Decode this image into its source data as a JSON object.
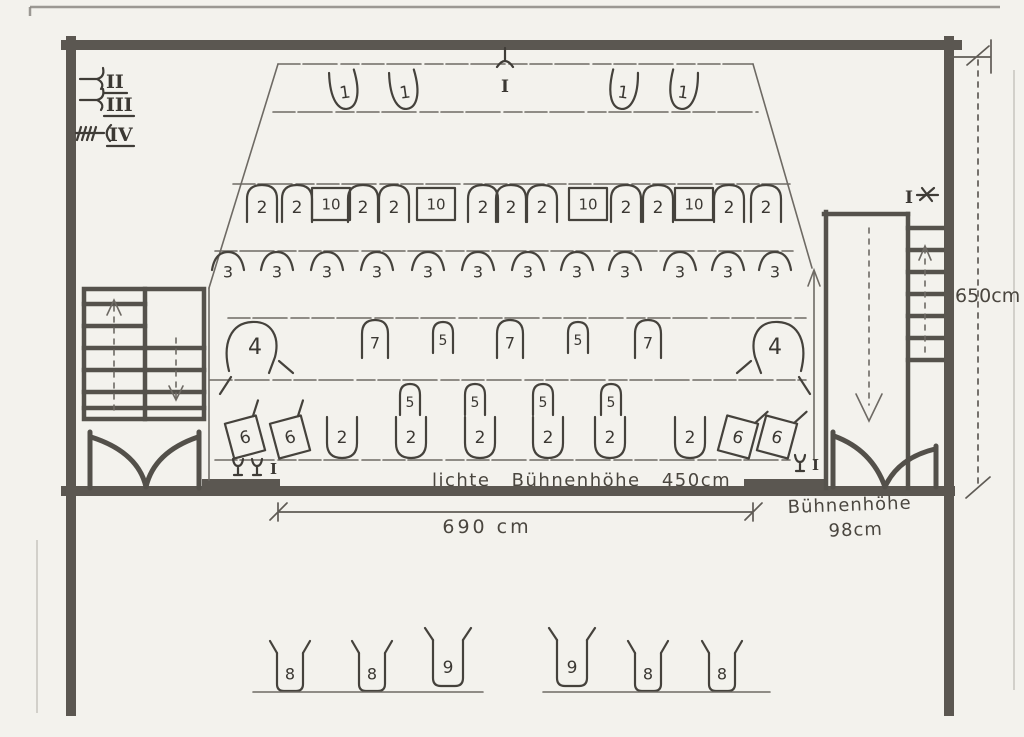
{
  "paper": {
    "bg": "#f3f2ed",
    "wall_color": "#5b5751",
    "pencil_color": "#6e6a64",
    "ink_color": "#45423c"
  },
  "legend": {
    "items": [
      {
        "numeral": "II"
      },
      {
        "numeral": "III"
      },
      {
        "numeral": "IV"
      }
    ]
  },
  "markers": {
    "top_center": "I",
    "right_wall": "I",
    "stage_left": "I",
    "stage_right": "I"
  },
  "dimensions": {
    "stage_width": "690 cm",
    "clear_stage_height": "lichte Bühnenhöhe 450cm",
    "stage_height_label": "Bühnenhöhe",
    "stage_height_value": "98cm",
    "room_height": "650cm"
  },
  "fixture_rows": [
    {
      "name": "row-1-top-lights",
      "items": [
        {
          "type": "open-u",
          "x": 345,
          "y": 93,
          "rot": -8,
          "label": "1"
        },
        {
          "type": "open-u",
          "x": 405,
          "y": 93,
          "rot": -8,
          "label": "1"
        },
        {
          "type": "open-u",
          "x": 623,
          "y": 93,
          "rot": 8,
          "label": "1"
        },
        {
          "type": "open-u",
          "x": 683,
          "y": 93,
          "rot": 8,
          "label": "1"
        }
      ]
    },
    {
      "name": "row-2-arch-lights",
      "items": [
        {
          "type": "arch",
          "x": 262,
          "y": 203,
          "label": "2"
        },
        {
          "type": "arch",
          "x": 297,
          "y": 203,
          "label": "2"
        },
        {
          "type": "box",
          "x": 331,
          "y": 204,
          "label": "10"
        },
        {
          "type": "arch",
          "x": 363,
          "y": 203,
          "label": "2"
        },
        {
          "type": "arch",
          "x": 394,
          "y": 203,
          "label": "2"
        },
        {
          "type": "box",
          "x": 436,
          "y": 204,
          "label": "10"
        },
        {
          "type": "arch",
          "x": 483,
          "y": 203,
          "label": "2"
        },
        {
          "type": "arch",
          "x": 511,
          "y": 203,
          "label": "2"
        },
        {
          "type": "arch",
          "x": 542,
          "y": 203,
          "label": "2"
        },
        {
          "type": "box",
          "x": 588,
          "y": 204,
          "label": "10"
        },
        {
          "type": "arch",
          "x": 626,
          "y": 203,
          "label": "2"
        },
        {
          "type": "arch",
          "x": 658,
          "y": 203,
          "label": "2"
        },
        {
          "type": "box",
          "x": 694,
          "y": 204,
          "label": "10"
        },
        {
          "type": "arch",
          "x": 729,
          "y": 203,
          "label": "2"
        },
        {
          "type": "arch",
          "x": 766,
          "y": 203,
          "label": "2"
        }
      ]
    },
    {
      "name": "row-3-dome-lights",
      "items": [
        {
          "type": "dome",
          "x": 228,
          "y": 267,
          "label": "3"
        },
        {
          "type": "dome",
          "x": 277,
          "y": 267,
          "label": "3"
        },
        {
          "type": "dome",
          "x": 327,
          "y": 267,
          "label": "3"
        },
        {
          "type": "dome",
          "x": 377,
          "y": 267,
          "label": "3"
        },
        {
          "type": "dome",
          "x": 428,
          "y": 267,
          "label": "3"
        },
        {
          "type": "dome",
          "x": 478,
          "y": 267,
          "label": "3"
        },
        {
          "type": "dome",
          "x": 528,
          "y": 267,
          "label": "3"
        },
        {
          "type": "dome",
          "x": 577,
          "y": 267,
          "label": "3"
        },
        {
          "type": "dome",
          "x": 625,
          "y": 267,
          "label": "3"
        },
        {
          "type": "dome",
          "x": 680,
          "y": 267,
          "label": "3"
        },
        {
          "type": "dome",
          "x": 728,
          "y": 267,
          "label": "3"
        },
        {
          "type": "dome",
          "x": 775,
          "y": 267,
          "label": "3"
        }
      ]
    },
    {
      "name": "row-4-mid-lights",
      "items": [
        {
          "type": "big4",
          "x": 255,
          "y": 347,
          "label": "4"
        },
        {
          "type": "arch7",
          "x": 375,
          "y": 340,
          "label": "7"
        },
        {
          "type": "arch5",
          "x": 443,
          "y": 338,
          "label": "5"
        },
        {
          "type": "arch7",
          "x": 510,
          "y": 340,
          "label": "7"
        },
        {
          "type": "arch5",
          "x": 578,
          "y": 338,
          "label": "5"
        },
        {
          "type": "arch7",
          "x": 648,
          "y": 340,
          "label": "7"
        },
        {
          "type": "big4m",
          "x": 775,
          "y": 347,
          "label": "4"
        }
      ]
    },
    {
      "name": "row-5-small-lights",
      "items": [
        {
          "type": "arch5",
          "x": 410,
          "y": 400,
          "label": "5"
        },
        {
          "type": "arch5",
          "x": 475,
          "y": 400,
          "label": "5"
        },
        {
          "type": "arch5",
          "x": 543,
          "y": 400,
          "label": "5"
        },
        {
          "type": "arch5",
          "x": 611,
          "y": 400,
          "label": "5"
        }
      ]
    },
    {
      "name": "row-6-apron-lights",
      "items": [
        {
          "type": "tiltbox",
          "x": 245,
          "y": 437,
          "rot": -15,
          "label": "6"
        },
        {
          "type": "tiltbox",
          "x": 290,
          "y": 437,
          "rot": -15,
          "label": "6"
        },
        {
          "type": "u2",
          "x": 342,
          "y": 437,
          "label": "2"
        },
        {
          "type": "u2",
          "x": 411,
          "y": 437,
          "label": "2"
        },
        {
          "type": "u2",
          "x": 480,
          "y": 437,
          "label": "2"
        },
        {
          "type": "u2",
          "x": 548,
          "y": 437,
          "label": "2"
        },
        {
          "type": "u2",
          "x": 610,
          "y": 437,
          "label": "2"
        },
        {
          "type": "u2",
          "x": 690,
          "y": 437,
          "label": "2"
        },
        {
          "type": "tiltbox",
          "x": 738,
          "y": 437,
          "rot": 15,
          "label": "6"
        },
        {
          "type": "tiltbox",
          "x": 777,
          "y": 437,
          "rot": 15,
          "label": "6"
        }
      ]
    },
    {
      "name": "row-7-footlights",
      "items": [
        {
          "type": "cup8",
          "x": 290,
          "y": 672,
          "label": "8"
        },
        {
          "type": "cup8",
          "x": 372,
          "y": 672,
          "label": "8"
        },
        {
          "type": "cup9",
          "x": 448,
          "y": 666,
          "label": "9"
        },
        {
          "type": "cup9",
          "x": 572,
          "y": 666,
          "label": "9"
        },
        {
          "type": "cup8",
          "x": 648,
          "y": 672,
          "label": "8"
        },
        {
          "type": "cup8",
          "x": 722,
          "y": 672,
          "label": "8"
        }
      ]
    }
  ],
  "footlight_baselines": [
    {
      "x1": 253,
      "x2": 483,
      "y": 692
    },
    {
      "x1": 543,
      "x2": 770,
      "y": 692
    }
  ]
}
